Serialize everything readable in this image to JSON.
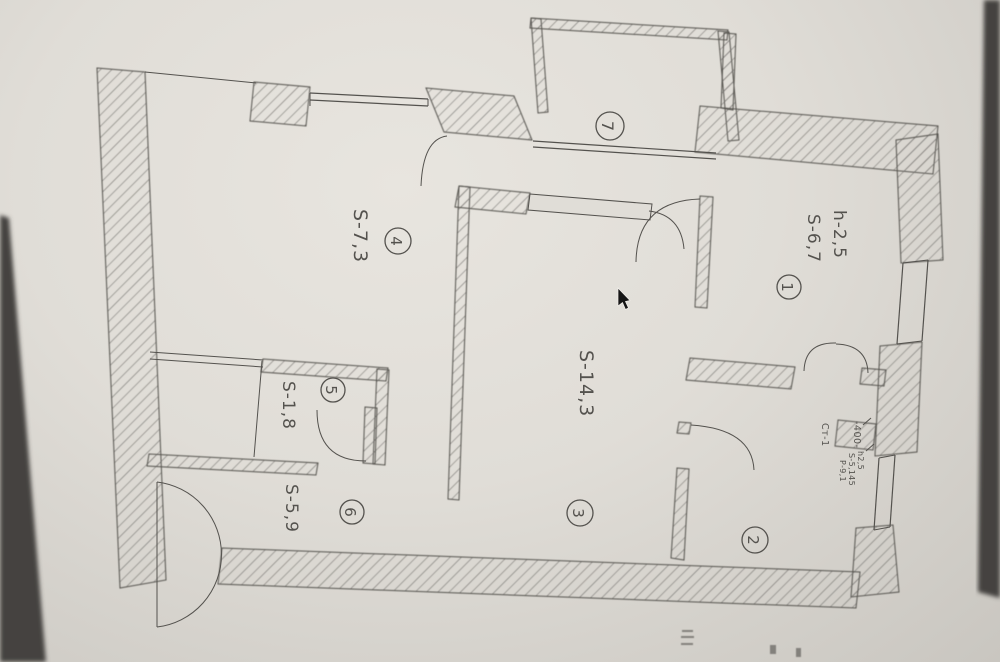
{
  "palette": {
    "paper": "#e0ddd7",
    "paper_edge": "#c9c6c0",
    "ink": "#54524e",
    "hatch": "#6f6d69",
    "photo_shadow": "#45433f",
    "cursor": "#161616"
  },
  "plan": {
    "type": "apartment-floor-plan-photo",
    "rooms": [
      {
        "number": "1",
        "height_label": "h-2,5",
        "area_label": "S-6,7"
      },
      {
        "number": "2",
        "stack_label": "Ст-1",
        "dimension_label": "-400-",
        "info_lines": [
          "h2,5",
          "S-5,145",
          "Р-9,1"
        ]
      },
      {
        "number": "3",
        "area_label": "S-14,3"
      },
      {
        "number": "4",
        "area_label": "S-7,3"
      },
      {
        "number": "5",
        "area_label": "S-1,8"
      },
      {
        "number": "6",
        "area_label": "S-5,9"
      },
      {
        "number": "7"
      }
    ]
  }
}
